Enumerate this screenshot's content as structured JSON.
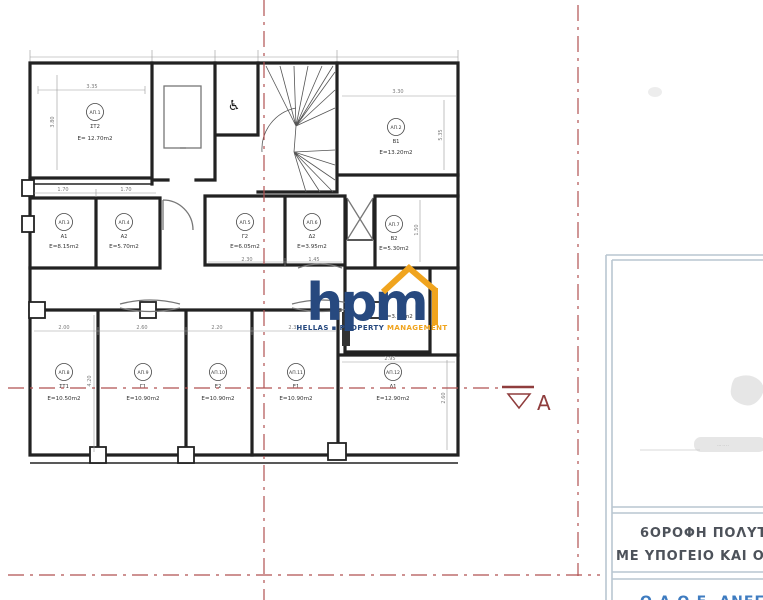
{
  "colors": {
    "wall": "#222222",
    "dim": "#7a7a7a",
    "section": "#b05252",
    "marker": "#8f3d3d",
    "navy": "#27497f",
    "orange": "#f0a41e",
    "panel": "#b9c6d1",
    "title": "#4d525a",
    "bluefoot": "#3f7cc0"
  },
  "plan": {
    "section_marker": "A",
    "small_room_area": "E=3.70m2",
    "rooms": [
      {
        "tag": "ΑΠ.1",
        "unit": "ΣΤ2",
        "area": "E= 12.70m2"
      },
      {
        "tag": "ΑΠ.2",
        "unit": "Β1",
        "area": "E=13.20m2"
      },
      {
        "tag": "ΑΠ.3",
        "unit": "Α1",
        "area": "E=8.15m2"
      },
      {
        "tag": "ΑΠ.4",
        "unit": "Α2",
        "area": "E=5.70m2"
      },
      {
        "tag": "ΑΠ.5",
        "unit": "Γ2",
        "area": "E=6.05m2"
      },
      {
        "tag": "ΑΠ.6",
        "unit": "Δ2",
        "area": "E=3.95m2"
      },
      {
        "tag": "ΑΠ.7",
        "unit": "Β2",
        "area": "E=5.30m2"
      },
      {
        "tag": "ΑΠ.8",
        "unit": "ΣΤ1",
        "area": "E=10.50m2"
      },
      {
        "tag": "ΑΠ.9",
        "unit": "Γ1",
        "area": "E=10.90m2"
      },
      {
        "tag": "ΑΠ.10",
        "unit": "Ε2",
        "area": "E=10.90m2"
      },
      {
        "tag": "ΑΠ.11",
        "unit": "Ε1",
        "area": "E=10.90m2"
      },
      {
        "tag": "ΑΠ.12",
        "unit": "Δ1",
        "area": "E=12.90m2"
      }
    ],
    "dims": [
      "3.35",
      "1.70",
      "1.70",
      "2.30",
      "1.45",
      "3.30",
      "2.00",
      "2.60",
      "2.20",
      "2.35",
      "2.95",
      "4.20",
      "3.80",
      "1.50",
      "5.35",
      "2.60"
    ]
  },
  "icons": {
    "wheelchair": "♿",
    "square_bullet": "▪"
  },
  "logo": {
    "word": "hpm",
    "tagline": [
      "HELLAS",
      "PROPERTY",
      "MANAGEMENT"
    ]
  },
  "panel": {
    "title_line1": "6ΟΡΟΦΗ  ΠΟΛΥΤΕ",
    "title_line2": "ΜΕ  ΥΠΟΓΕΙΟ ΚΑΙ Ο",
    "footer_partial": "Ο.Α.Ο.Ε.  ΑΝΕΓΕΡΣΗ"
  }
}
